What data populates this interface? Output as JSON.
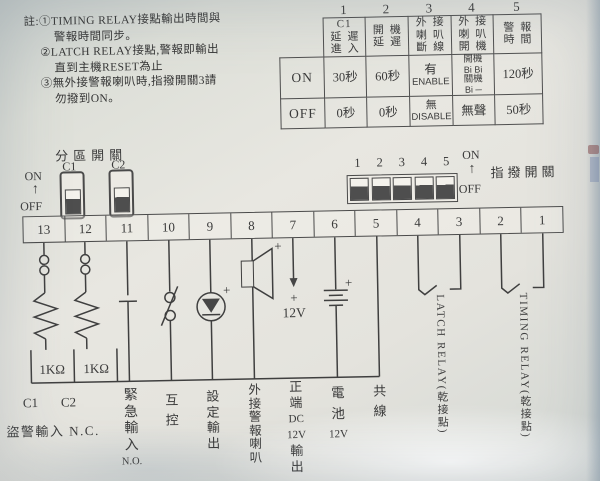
{
  "colors": {
    "ink": "#3a3a3a",
    "paper": "#e8e7e1",
    "switch_dark": "#4e4e4e"
  },
  "notes": {
    "lines": [
      "註:①TIMING RELAY接點輸出時間與",
      "警報時間同步。",
      "②LATCH RELAY接點,警報即輸出",
      "直到主機RESET為止",
      "③無外接警報喇叭時,指撥開關3請",
      "勿撥到ON。"
    ]
  },
  "table": {
    "col_numbers": [
      "1",
      "2",
      "3",
      "4",
      "5"
    ],
    "headers": [
      [
        "C1",
        "延遲",
        "進入"
      ],
      [
        "開機",
        "延遲"
      ],
      [
        "外接",
        "喇叭",
        "斷線"
      ],
      [
        "外接",
        "喇叭",
        "開機"
      ],
      [
        "警報",
        "時間"
      ]
    ],
    "rows": [
      {
        "label": "ON",
        "c1": "30秒",
        "c2": "60秒",
        "c3": [
          "有",
          "ENABLE"
        ],
        "c4": [
          "開機",
          "Bi Bi",
          "關機",
          "Bi ─"
        ],
        "c5": "120秒"
      },
      {
        "label": "OFF",
        "c1": "0秒",
        "c2": "0秒",
        "c3": [
          "無",
          "DISABLE"
        ],
        "c4": "無聲",
        "c5": "50秒"
      }
    ]
  },
  "zone_switch": {
    "title": "分區開關",
    "c1": "C1",
    "c2": "C2",
    "on": "ON",
    "off": "OFF",
    "arrow": "↑"
  },
  "dip_switch": {
    "title": "指撥開關",
    "numbers": [
      "1",
      "2",
      "3",
      "4",
      "5"
    ],
    "on": "ON",
    "off": "OFF",
    "arrow": "↑"
  },
  "terminal_strip": {
    "numbers": [
      "13",
      "12",
      "11",
      "10",
      "9",
      "8",
      "7",
      "6",
      "5",
      "4",
      "3",
      "2",
      "1"
    ]
  },
  "circuit": {
    "r1": "1KΩ",
    "r2": "1KΩ",
    "plus": "+",
    "dc": "12V"
  },
  "bottom_labels": {
    "c1": "C1",
    "c2": "C2",
    "nc": "盜警輸入 N.C.",
    "emergency": [
      "緊",
      "急",
      "輸",
      "入",
      "N.O."
    ],
    "mutual": [
      "互",
      "控"
    ],
    "setting": [
      "設",
      "定",
      "輸",
      "出"
    ],
    "speaker": [
      "外",
      "接",
      "警",
      "報",
      "喇",
      "叭"
    ],
    "dc_out": [
      "正",
      "端",
      "DC",
      "12V",
      "輸",
      "出"
    ],
    "battery": [
      "電",
      "池",
      "12V"
    ],
    "common": [
      "共",
      "線"
    ],
    "latch": "LATCH RELAY(乾接點)",
    "timing": "TIMING RELAY(乾接點)"
  }
}
